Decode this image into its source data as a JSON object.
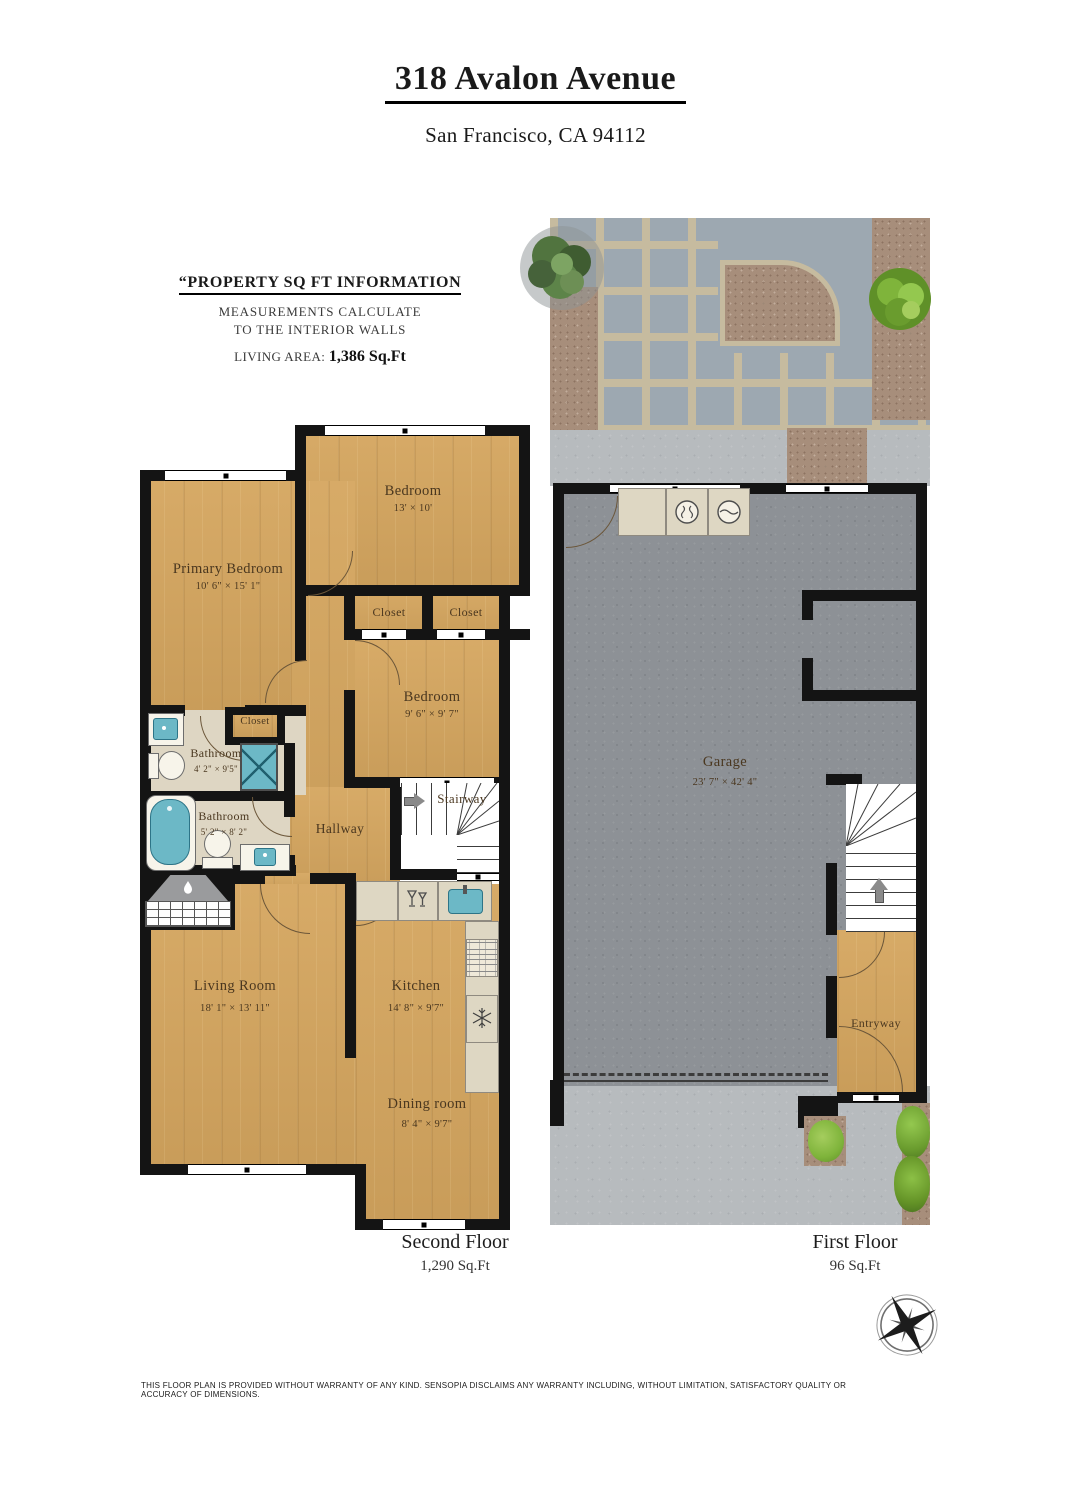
{
  "header": {
    "title": "318 Avalon Avenue",
    "subtitle": "San Francisco, CA 94112"
  },
  "property_info": {
    "heading": "“PROPERTY SQ FT INFORMATION",
    "line1": "MEASUREMENTS CALCULATE",
    "line2": "TO THE INTERIOR WALLS",
    "living_area_label": "LIVING AREA:",
    "living_area_value": "1,386 Sq.Ft"
  },
  "second_floor": {
    "caption": "Second Floor",
    "area": "1,290 Sq.Ft",
    "rooms": {
      "bedroom_top": {
        "name": "Bedroom",
        "dims": "13' × 10'"
      },
      "primary_bedroom": {
        "name": "Primary Bedroom",
        "dims": "10' 6\" × 15' 1\""
      },
      "closet_left": {
        "name": "Closet"
      },
      "closet_right": {
        "name": "Closet"
      },
      "closet_small": {
        "name": "Closet"
      },
      "bedroom_mid": {
        "name": "Bedroom",
        "dims": "9' 6\" × 9' 7\""
      },
      "bathroom_upper": {
        "name": "Bathroom",
        "dims": "4' 2\" × 9'5\""
      },
      "bathroom_lower": {
        "name": "Bathroom",
        "dims": "5' 2\" × 8' 2\""
      },
      "hallway": {
        "name": "Hallway"
      },
      "stairway": {
        "name": "Stairway"
      },
      "living_room": {
        "name": "Living Room",
        "dims": "18' 1\" × 13' 11\""
      },
      "kitchen": {
        "name": "Kitchen",
        "dims": "14' 8\" × 9'7\""
      },
      "dining_room": {
        "name": "Dining room",
        "dims": "8' 4\" × 9'7\""
      }
    }
  },
  "first_floor": {
    "caption": "First Floor",
    "area": "96 Sq.Ft",
    "rooms": {
      "garage": {
        "name": "Garage",
        "dims": "23' 7\" × 42' 4\""
      },
      "entryway": {
        "name": "Entryway"
      }
    }
  },
  "footer": {
    "disclaimer": "THIS FLOOR PLAN IS PROVIDED WITHOUT WARRANTY OF ANY KIND. SENSOPIA DISCLAIMS ANY WARRANTY INCLUDING, WITHOUT LIMITATION, SATISFACTORY QUALITY OR ACCURACY OF DIMENSIONS."
  },
  "palette": {
    "wood": "#d5a65f",
    "wall": "#141414",
    "bathroom_floor": "#ded6c3",
    "fixture_blue": "#6cb8c6",
    "garage_floor": "#8d9196",
    "paver": "#9da8b1",
    "grout": "#c6bb9f",
    "soil": "#a78e7b",
    "concrete": "#b7bbbe",
    "counter": "#ded7c3",
    "plant_dark": "#4e6b41",
    "plant_bright": "#7fb43b",
    "label_text": "#4a371f"
  }
}
